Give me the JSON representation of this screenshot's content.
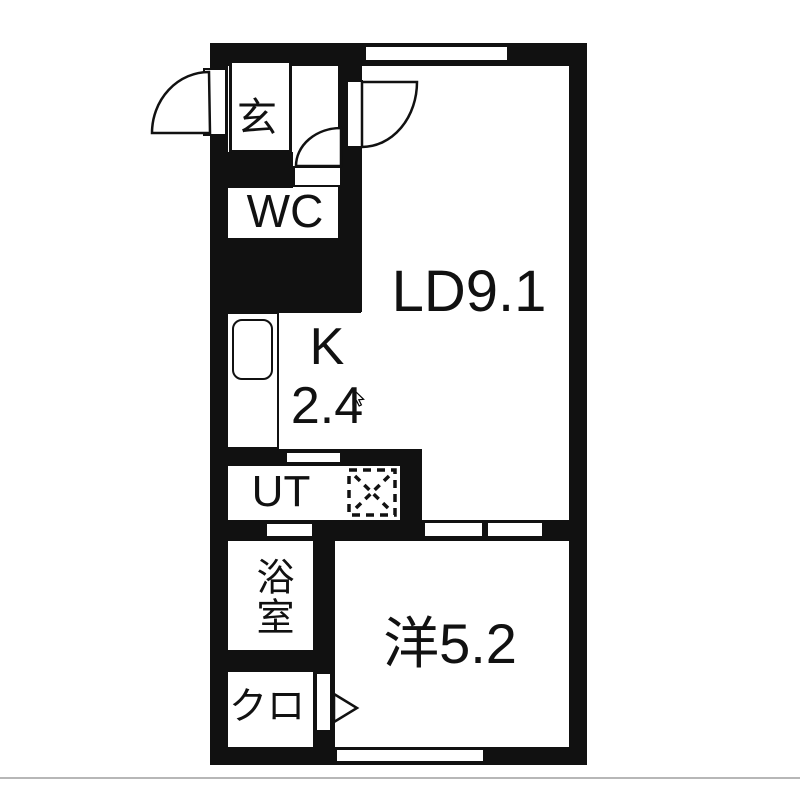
{
  "colors": {
    "wall": "#111111",
    "background": "#ffffff",
    "ink": "#111111",
    "divider": "#b7b7b7"
  },
  "rooms": {
    "genkan": {
      "label": "玄"
    },
    "wc": {
      "label": "WC"
    },
    "living": {
      "label": "LD9.1"
    },
    "kitchen": {
      "label_line1": "K",
      "label_line2": "2.4"
    },
    "utility": {
      "label": "UT"
    },
    "bathroom": {
      "label": "浴室"
    },
    "closet": {
      "label": "クロ"
    },
    "western_room": {
      "label": "洋5.2"
    }
  },
  "fixtures": {
    "entrance_door": "entrance-door-swing",
    "living_door": "living-door-swing",
    "wc_door": "wc-door-swing",
    "kitchen_sink": "kitchen-sink",
    "washer_space": "washing-machine-space",
    "closet_door": "closet-door-arrow",
    "windows": [
      "top-window",
      "bottom-window"
    ],
    "cursor": "mouse-cursor"
  }
}
